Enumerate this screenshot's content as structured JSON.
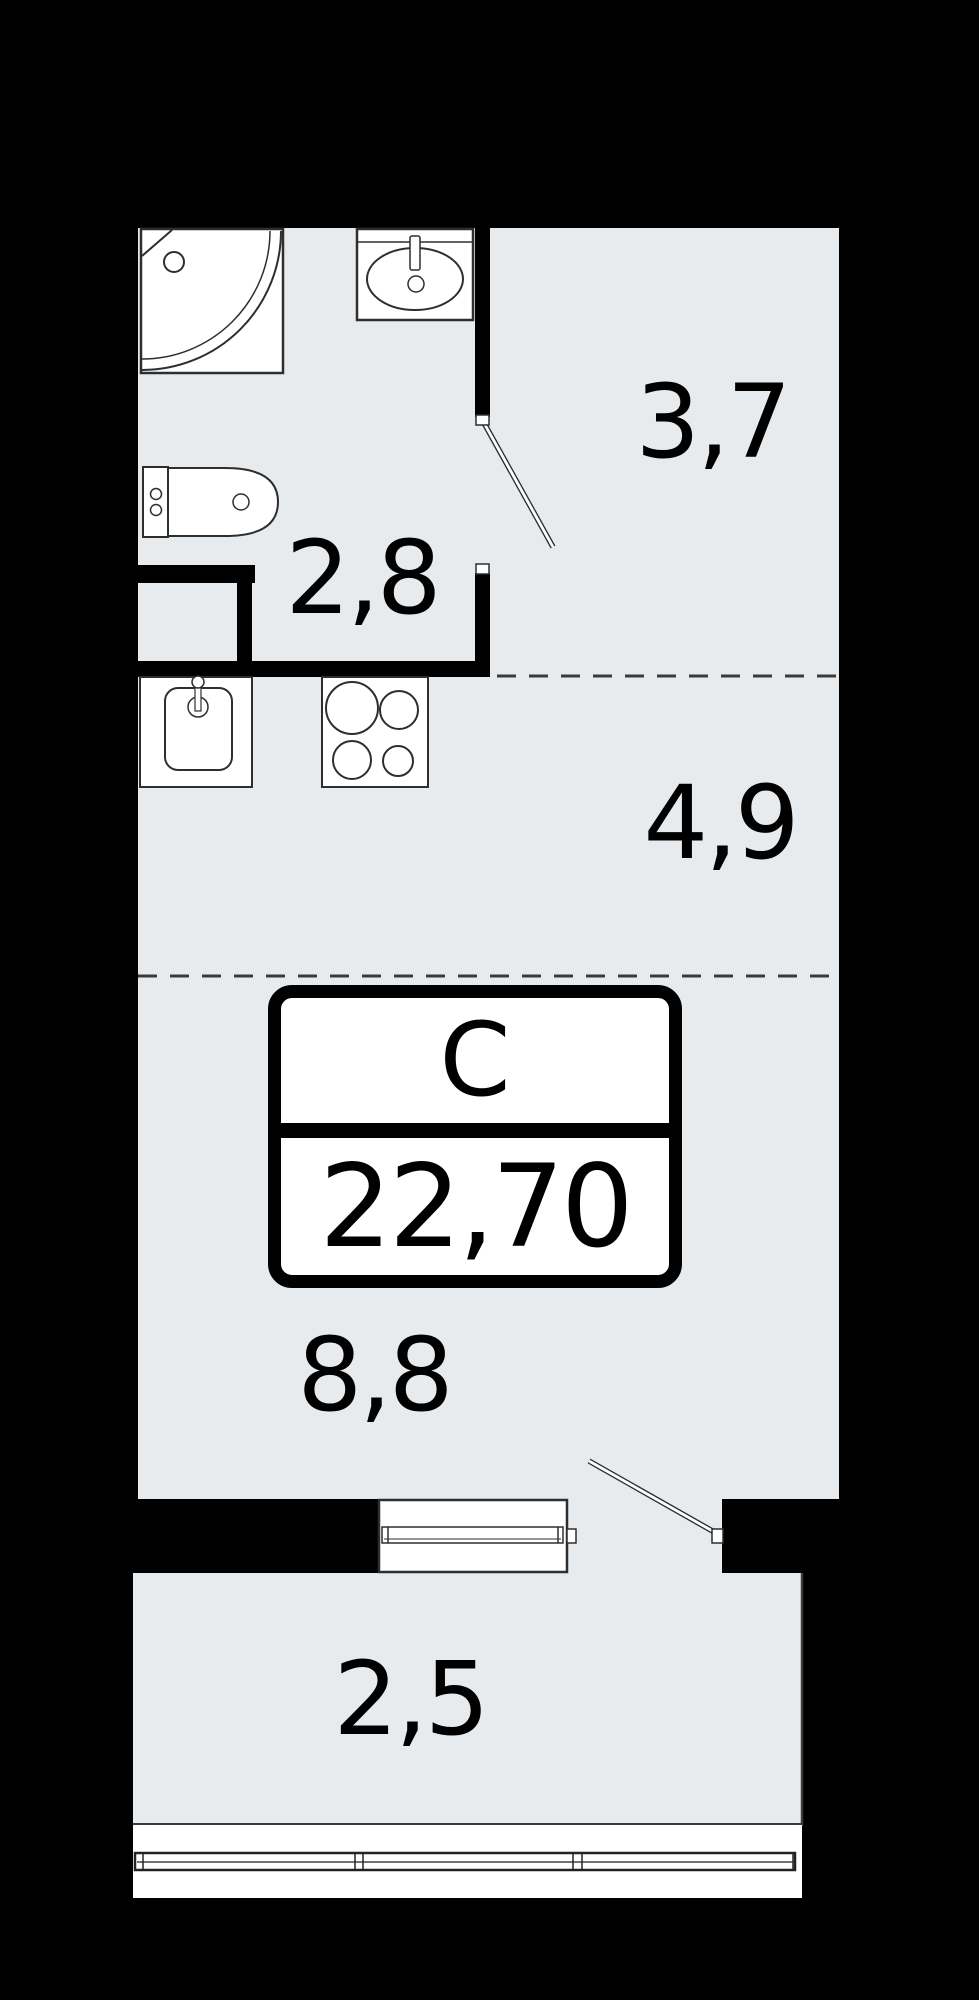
{
  "plan": {
    "stamp": {
      "type_label": "С",
      "total_area": "22,70"
    },
    "rooms": {
      "hallway": {
        "name": "hallway",
        "area": "3,7"
      },
      "bathroom": {
        "name": "bathroom",
        "area": "2,8"
      },
      "kitchen": {
        "name": "kitchen",
        "area": "4,9"
      },
      "living": {
        "name": "living-room",
        "area": "8,8"
      },
      "balcony": {
        "name": "balcony",
        "area": "2,5"
      }
    },
    "colors": {
      "floor": "#e8ebee",
      "wall": "#000000",
      "fixture_fill": "#ffffff",
      "outline": "#2e2e2e",
      "dash": "#3a3a3a",
      "text": "#000000"
    },
    "fixtures": [
      "corner-shower",
      "washbasin",
      "toilet",
      "duct-shaft",
      "kitchen-sink",
      "cooktop-4-burner",
      "balcony-window",
      "bathroom-door",
      "balcony-door",
      "balcony-railing"
    ]
  }
}
